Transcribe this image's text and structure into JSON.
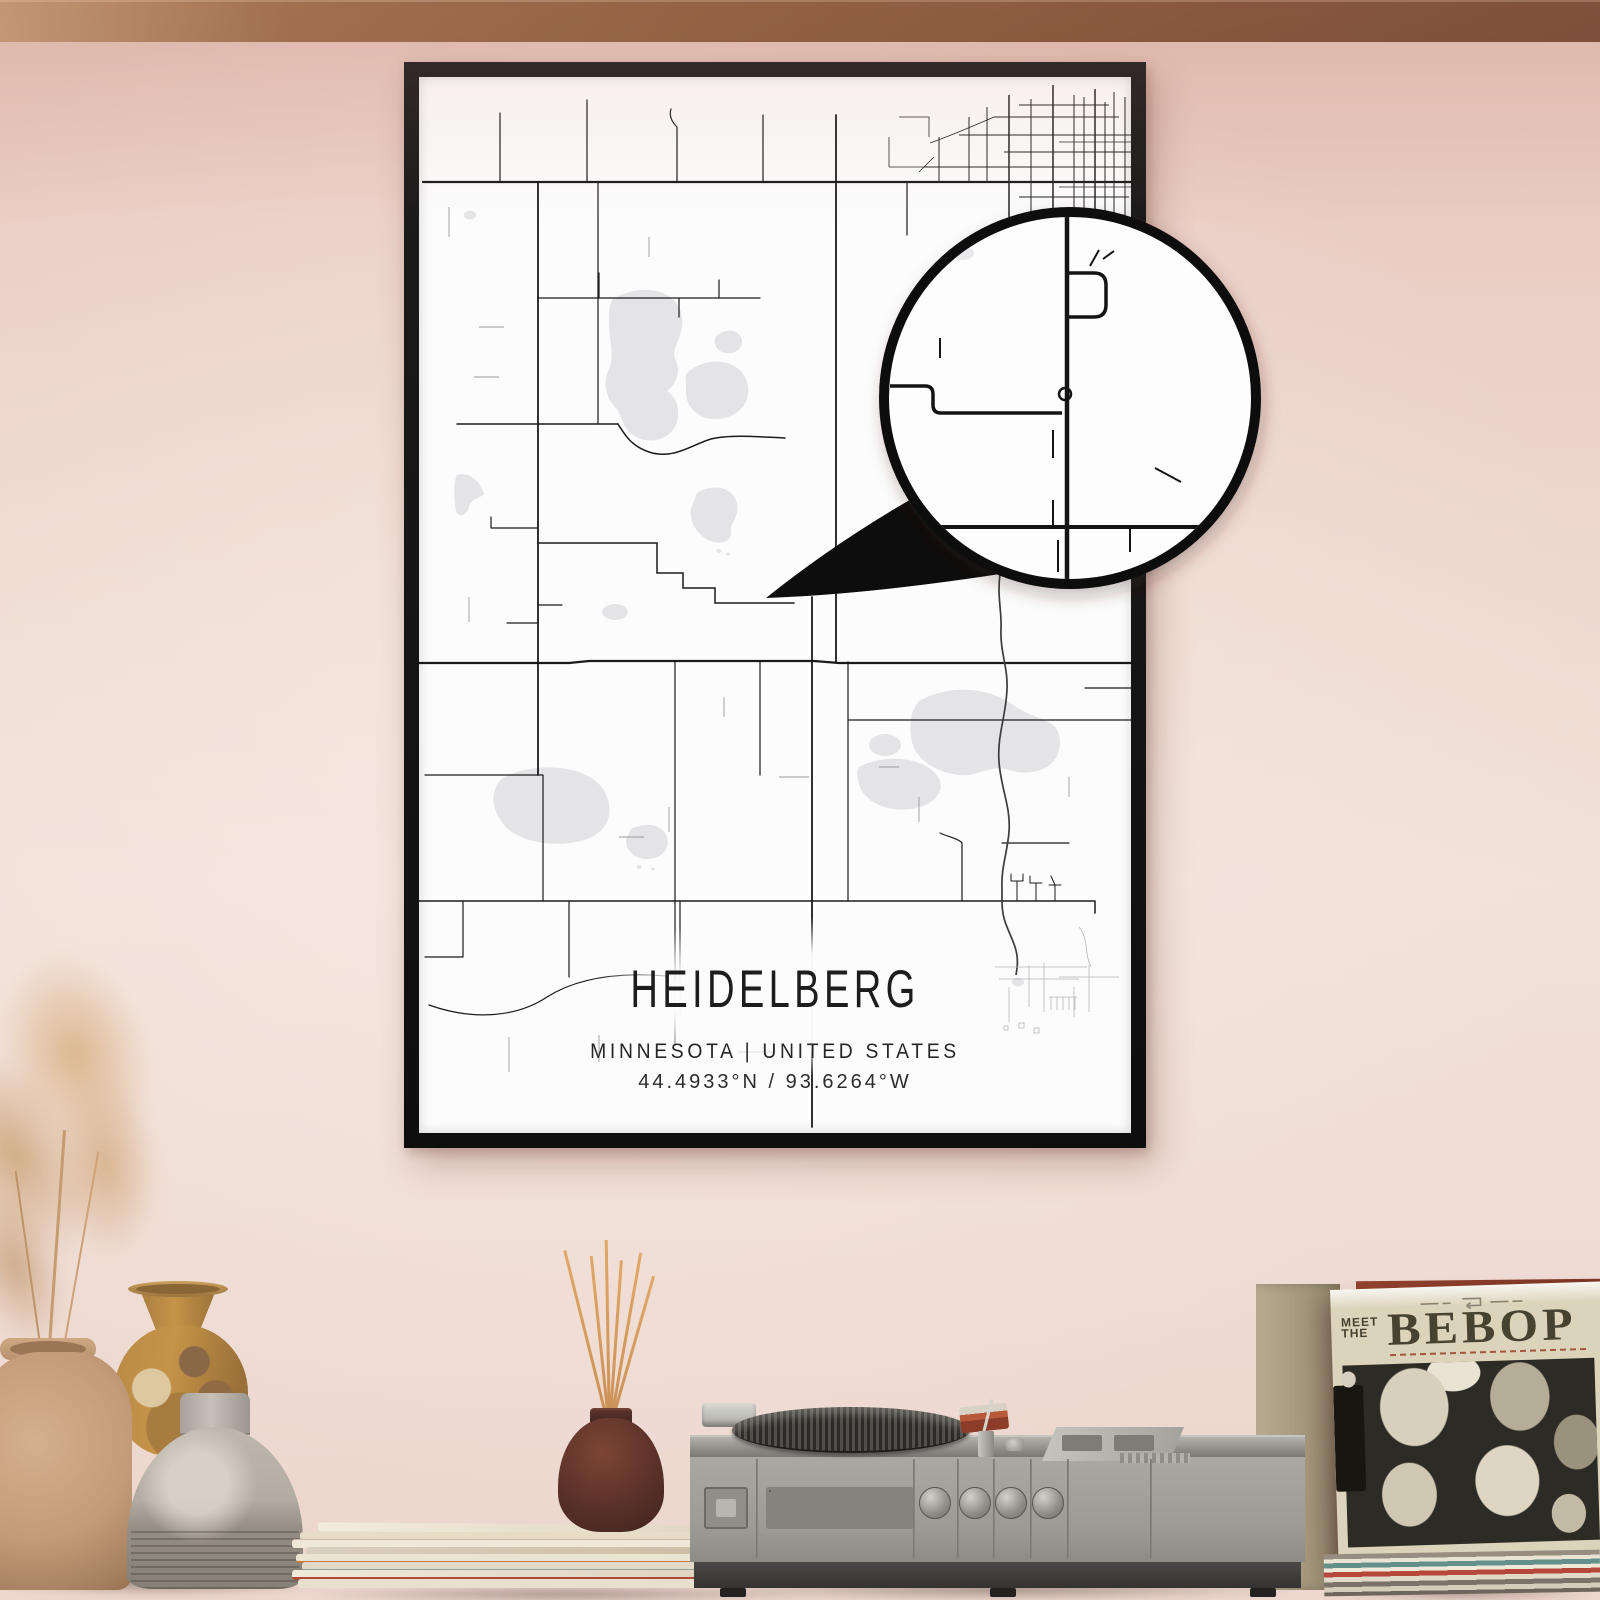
{
  "poster": {
    "title": "HEIDELBERG",
    "subtitle": "MINNESOTA | UNITED STATES",
    "coordinates": "44.4933°N / 93.6264°W"
  },
  "record_sleeve": {
    "pretitle_line1": "MEET",
    "pretitle_line2": "THE",
    "title": "BEBOP",
    "header_icon": "stereo-loop-icon"
  },
  "colors": {
    "wall_pink": "#eedad1",
    "frame_black": "#131313",
    "poster_white": "#fcfcfc",
    "map_road": "#1b1b1b",
    "map_water": "#e4e4e6",
    "table_wood": "#8a5a3b",
    "accent_red_spine": "#b04a38"
  }
}
